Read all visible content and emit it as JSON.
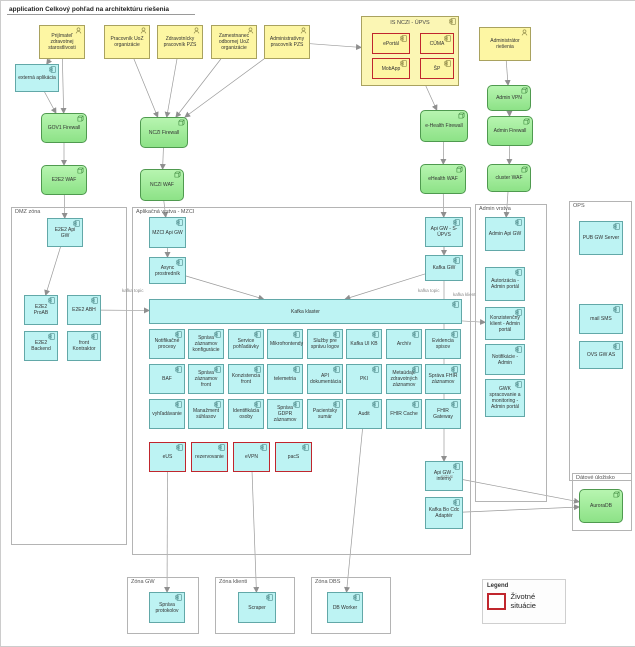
{
  "title": "application Celkový pohľad na architektúru riešenia",
  "legend": {
    "title": "Legend",
    "items": [
      {
        "label": "Životné situácie",
        "color": "#c0262d"
      }
    ]
  },
  "diagram": {
    "containers": [
      {
        "id": "dmz-zona",
        "label": "DMZ zóna",
        "x": 10,
        "y": 206,
        "w": 116,
        "h": 338
      },
      {
        "id": "aplikacna-vrstva-mzci",
        "label": "Aplikačná vrstva - MZCI",
        "x": 131,
        "y": 206,
        "w": 339,
        "h": 348
      },
      {
        "id": "admin-vrstva",
        "label": "Admin vrstva",
        "x": 474,
        "y": 203,
        "w": 72,
        "h": 298
      },
      {
        "id": "ops",
        "label": "OPS",
        "x": 568,
        "y": 200,
        "w": 63,
        "h": 280
      },
      {
        "id": "datove-ulozisko",
        "label": "Dátové úložisko",
        "x": 571,
        "y": 472,
        "w": 60,
        "h": 58
      },
      {
        "id": "zona-gw",
        "label": "Zóna GW",
        "x": 126,
        "y": 576,
        "w": 72,
        "h": 57
      },
      {
        "id": "zona-klienti",
        "label": "Zóna klienti",
        "x": 214,
        "y": 576,
        "w": 80,
        "h": 57
      },
      {
        "id": "zona-dbs",
        "label": "Zóna DBS",
        "x": 310,
        "y": 576,
        "w": 80,
        "h": 57
      }
    ],
    "nodes": [
      {
        "id": "actor-prijimatel",
        "type": "actor",
        "label": "Prijímateľ zdravotnej starostlivosti",
        "x": 38,
        "y": 24,
        "w": 46,
        "h": 34
      },
      {
        "id": "actor-pracovnik-uoz",
        "type": "actor",
        "label": "Pracovník UoZ organizácie",
        "x": 103,
        "y": 24,
        "w": 46,
        "h": 34
      },
      {
        "id": "actor-zdravotnicky-pracovnik",
        "type": "actor",
        "label": "Zdravotnícky pracovník PZS",
        "x": 156,
        "y": 24,
        "w": 46,
        "h": 34
      },
      {
        "id": "actor-zamestnanec-odbornej",
        "type": "actor",
        "label": "Zamestnanec odbornej UoZ organizácie",
        "x": 210,
        "y": 24,
        "w": 46,
        "h": 34
      },
      {
        "id": "actor-administrativny",
        "type": "actor",
        "label": "Administratívny pracovník PZS",
        "x": 263,
        "y": 24,
        "w": 46,
        "h": 34
      },
      {
        "id": "actor-administrator",
        "type": "actor",
        "label": "Administrátor riešenia",
        "x": 478,
        "y": 26,
        "w": 52,
        "h": 34
      },
      {
        "id": "externa-aplikacia",
        "type": "app",
        "label": "externá aplikácia",
        "x": 14,
        "y": 63,
        "w": 44,
        "h": 28
      },
      {
        "id": "is-nczi-upvs",
        "type": "ygroup",
        "label": "IS NCZI - ÚPVS",
        "x": 360,
        "y": 15,
        "w": 98,
        "h": 70
      },
      {
        "id": "ls-eportal",
        "type": "yred",
        "label": "ePortál",
        "x": 371,
        "y": 32,
        "w": 38,
        "h": 21
      },
      {
        "id": "ls-cuma",
        "type": "yred",
        "label": "CÚMA",
        "x": 419,
        "y": 32,
        "w": 34,
        "h": 21
      },
      {
        "id": "ls-mobapp",
        "type": "yred",
        "label": "MobApp",
        "x": 371,
        "y": 57,
        "w": 38,
        "h": 21
      },
      {
        "id": "ls-sp",
        "type": "yred",
        "label": "ŠP",
        "x": 419,
        "y": 57,
        "w": 34,
        "h": 21
      },
      {
        "id": "gov1-firewall",
        "type": "gnode",
        "label": "GOV1 Firewall",
        "x": 40,
        "y": 112,
        "w": 46,
        "h": 30
      },
      {
        "id": "e2e2-waf",
        "type": "gnode",
        "label": "E2E2 WAF",
        "x": 40,
        "y": 164,
        "w": 46,
        "h": 30
      },
      {
        "id": "nczi-firewall",
        "type": "gnode",
        "label": "NCZI Firewall",
        "x": 139,
        "y": 116,
        "w": 48,
        "h": 31
      },
      {
        "id": "nczi-waf",
        "type": "gnode",
        "label": "NCZI WAF",
        "x": 139,
        "y": 168,
        "w": 44,
        "h": 32
      },
      {
        "id": "ehealth-firewall",
        "type": "gnode",
        "label": "e-Health Firewall",
        "x": 419,
        "y": 109,
        "w": 48,
        "h": 32
      },
      {
        "id": "ehealth-waf",
        "type": "gnode",
        "label": "eHealth WAF",
        "x": 419,
        "y": 163,
        "w": 46,
        "h": 30
      },
      {
        "id": "admin-vpn",
        "type": "gnode",
        "label": "Admin VPN",
        "x": 486,
        "y": 84,
        "w": 44,
        "h": 26
      },
      {
        "id": "admin-firewall",
        "type": "gnode",
        "label": "Admin Firewall",
        "x": 486,
        "y": 115,
        "w": 46,
        "h": 30
      },
      {
        "id": "cluster-waf",
        "type": "gnode",
        "label": "cluster WAF",
        "x": 486,
        "y": 163,
        "w": 44,
        "h": 28
      },
      {
        "id": "auroradb",
        "type": "gnode",
        "label": "AuroraDB",
        "x": 578,
        "y": 488,
        "w": 44,
        "h": 34
      },
      {
        "id": "e2e2-api-gw",
        "type": "app",
        "label": "E2E2 Api GW",
        "x": 46,
        "y": 217,
        "w": 36,
        "h": 29
      },
      {
        "id": "e2e2-proab",
        "type": "app",
        "label": "E2E2 ProAB",
        "x": 23,
        "y": 294,
        "w": 34,
        "h": 30
      },
      {
        "id": "e2e2-abh",
        "type": "app",
        "label": "E2E2 ABH",
        "x": 66,
        "y": 294,
        "w": 34,
        "h": 30
      },
      {
        "id": "e2e2-backend",
        "type": "app",
        "label": "E2E2 Backend",
        "x": 23,
        "y": 330,
        "w": 34,
        "h": 30
      },
      {
        "id": "front-kontraktor",
        "type": "app",
        "label": "front Kontraktor",
        "x": 66,
        "y": 330,
        "w": 34,
        "h": 30
      },
      {
        "id": "mzci-api-gw",
        "type": "app",
        "label": "MZCI Api GW",
        "x": 148,
        "y": 216,
        "w": 37,
        "h": 31
      },
      {
        "id": "async-prostrednik",
        "type": "app",
        "label": "Async prostredník",
        "x": 148,
        "y": 256,
        "w": 37,
        "h": 27
      },
      {
        "id": "kafka-klaster",
        "type": "app",
        "label": "Kafka klaster",
        "x": 148,
        "y": 298,
        "w": 313,
        "h": 25
      },
      {
        "id": "notifikacne-procesy",
        "type": "app",
        "label": "Notifikačné procesy",
        "x": 148,
        "y": 328,
        "w": 36,
        "h": 30
      },
      {
        "id": "sprava-zaznamov-konfiguracie",
        "type": "app",
        "label": "Správa záznamov konfigurácie",
        "x": 187,
        "y": 328,
        "w": 36,
        "h": 30
      },
      {
        "id": "service-pohladavky",
        "type": "app",
        "label": "Service pohľadávky",
        "x": 227,
        "y": 328,
        "w": 36,
        "h": 30
      },
      {
        "id": "mikrofrontendy",
        "type": "app",
        "label": "Mikrofrontendy",
        "x": 266,
        "y": 328,
        "w": 36,
        "h": 30
      },
      {
        "id": "sluzby-pre-spravu-logov",
        "type": "app",
        "label": "Služby pre správu logov",
        "x": 306,
        "y": 328,
        "w": 36,
        "h": 30
      },
      {
        "id": "kafka-ui-kb",
        "type": "app",
        "label": "Kafka UI KB",
        "x": 345,
        "y": 328,
        "w": 36,
        "h": 30
      },
      {
        "id": "archiv",
        "type": "app",
        "label": "Archív",
        "x": 385,
        "y": 328,
        "w": 36,
        "h": 30
      },
      {
        "id": "evidencia-spisov",
        "type": "app",
        "label": "Evidencia spisov",
        "x": 424,
        "y": 328,
        "w": 36,
        "h": 30
      },
      {
        "id": "baf",
        "type": "app",
        "label": "BAF",
        "x": 148,
        "y": 363,
        "w": 36,
        "h": 30
      },
      {
        "id": "sprava-zaznamov-front",
        "type": "app",
        "label": "Správa záznamov front",
        "x": 187,
        "y": 363,
        "w": 36,
        "h": 30
      },
      {
        "id": "konzistencia-front",
        "type": "app",
        "label": "Konzistencia front",
        "x": 227,
        "y": 363,
        "w": 36,
        "h": 30
      },
      {
        "id": "telemetria",
        "type": "app",
        "label": "telemetria",
        "x": 266,
        "y": 363,
        "w": 36,
        "h": 30
      },
      {
        "id": "api-dokumentacia",
        "type": "app",
        "label": "API dokumentácia",
        "x": 306,
        "y": 363,
        "w": 36,
        "h": 30
      },
      {
        "id": "pki",
        "type": "app",
        "label": "PKI",
        "x": 345,
        "y": 363,
        "w": 36,
        "h": 30
      },
      {
        "id": "metaudaje-zdravotnych-zaznamov",
        "type": "app",
        "label": "Metaúdaje zdravotných záznamov",
        "x": 385,
        "y": 363,
        "w": 36,
        "h": 30
      },
      {
        "id": "sprava-fhir-zaznamov",
        "type": "app",
        "label": "Správa FHIR záznamov",
        "x": 424,
        "y": 363,
        "w": 36,
        "h": 30
      },
      {
        "id": "vyhladavanie",
        "type": "app",
        "label": "vyhľadávanie",
        "x": 148,
        "y": 398,
        "w": 36,
        "h": 30
      },
      {
        "id": "manazment-suhlasov",
        "type": "app",
        "label": "Manažment súhlasov",
        "x": 187,
        "y": 398,
        "w": 36,
        "h": 30
      },
      {
        "id": "identifikacia-osoby",
        "type": "app",
        "label": "Identifikácia osoby",
        "x": 227,
        "y": 398,
        "w": 36,
        "h": 30
      },
      {
        "id": "sprava-gdpr-zaznamov",
        "type": "app",
        "label": "Správa GDPR záznamov",
        "x": 266,
        "y": 398,
        "w": 36,
        "h": 30
      },
      {
        "id": "pacientsky-sumar",
        "type": "app",
        "label": "Pacientsky sumár",
        "x": 306,
        "y": 398,
        "w": 36,
        "h": 30
      },
      {
        "id": "audit",
        "type": "app",
        "label": "Audit",
        "x": 345,
        "y": 398,
        "w": 36,
        "h": 30
      },
      {
        "id": "fhir-cache",
        "type": "app",
        "label": "FHIR Cache",
        "x": 385,
        "y": 398,
        "w": 36,
        "h": 30
      },
      {
        "id": "fhir-gateway",
        "type": "app",
        "label": "FHIR Gateway",
        "x": 424,
        "y": 398,
        "w": 36,
        "h": 30
      },
      {
        "id": "ls-eus",
        "type": "cred",
        "label": "eUS",
        "x": 148,
        "y": 441,
        "w": 37,
        "h": 30
      },
      {
        "id": "ls-rezervovanie",
        "type": "cred",
        "label": "rezervovanie",
        "x": 190,
        "y": 441,
        "w": 37,
        "h": 30
      },
      {
        "id": "ls-evpn",
        "type": "cred",
        "label": "eVPN",
        "x": 232,
        "y": 441,
        "w": 37,
        "h": 30
      },
      {
        "id": "ls-pacs",
        "type": "cred",
        "label": "pacS",
        "x": 274,
        "y": 441,
        "w": 37,
        "h": 30
      },
      {
        "id": "api-gw-s-upvs",
        "type": "app",
        "label": "Api GW - S-ÚPVS",
        "x": 424,
        "y": 216,
        "w": 38,
        "h": 30
      },
      {
        "id": "kafka-gw",
        "type": "app",
        "label": "Kafka GW",
        "x": 424,
        "y": 254,
        "w": 38,
        "h": 26
      },
      {
        "id": "api-gw-interny",
        "type": "app",
        "label": "Api GW - interný",
        "x": 424,
        "y": 460,
        "w": 38,
        "h": 30
      },
      {
        "id": "kafka-bo-cdc-adapter",
        "type": "app",
        "label": "Kafka Bo Cdc Adaptér",
        "x": 424,
        "y": 496,
        "w": 38,
        "h": 32
      },
      {
        "id": "admin-api-gw",
        "type": "app",
        "label": "Admin Api GW",
        "x": 484,
        "y": 216,
        "w": 40,
        "h": 34
      },
      {
        "id": "autorizacia-admin-portal",
        "type": "app",
        "label": "Autorizácia - Admin portál",
        "x": 484,
        "y": 266,
        "w": 40,
        "h": 34
      },
      {
        "id": "konzistencny-klient-admin-portal",
        "type": "app",
        "label": "Konzistenčný klient - Admin portál",
        "x": 484,
        "y": 306,
        "w": 40,
        "h": 33
      },
      {
        "id": "notifikacie-admin",
        "type": "app",
        "label": "Notifikácie - Admin",
        "x": 484,
        "y": 343,
        "w": 40,
        "h": 31
      },
      {
        "id": "gwk-spracovanie-admin-portal",
        "type": "app",
        "label": "GWK spracovanie a monitoring - Admin portál",
        "x": 484,
        "y": 378,
        "w": 40,
        "h": 38
      },
      {
        "id": "pub-gw-server",
        "type": "app",
        "label": "PUB GW Server",
        "x": 578,
        "y": 220,
        "w": 44,
        "h": 34
      },
      {
        "id": "mail-sms",
        "type": "app",
        "label": "mail SMS",
        "x": 578,
        "y": 303,
        "w": 44,
        "h": 30
      },
      {
        "id": "ovs-gw-as",
        "type": "app",
        "label": "OVS GW AS",
        "x": 578,
        "y": 340,
        "w": 44,
        "h": 28
      },
      {
        "id": "sprava-protokolov",
        "type": "app",
        "label": "Správa protokolov",
        "x": 148,
        "y": 591,
        "w": 36,
        "h": 31
      },
      {
        "id": "scraper",
        "type": "app",
        "label": "Scraper",
        "x": 237,
        "y": 591,
        "w": 38,
        "h": 31
      },
      {
        "id": "db-worker",
        "type": "app",
        "label": "DB Worker",
        "x": 326,
        "y": 591,
        "w": 36,
        "h": 31
      }
    ],
    "edges": [
      {
        "from": "actor-prijimatel",
        "to": "externa-aplikacia"
      },
      {
        "from": "actor-prijimatel",
        "to": "gov1-firewall"
      },
      {
        "from": "externa-aplikacia",
        "to": "gov1-firewall"
      },
      {
        "from": "actor-pracovnik-uoz",
        "to": "nczi-firewall"
      },
      {
        "from": "actor-zdravotnicky-pracovnik",
        "to": "nczi-firewall"
      },
      {
        "from": "actor-zamestnanec-odbornej",
        "to": "nczi-firewall"
      },
      {
        "from": "actor-administrativny",
        "to": "nczi-firewall"
      },
      {
        "from": "actor-administrativny",
        "to": "is-nczi-upvs"
      },
      {
        "from": "is-nczi-upvs",
        "to": "ehealth-firewall"
      },
      {
        "from": "actor-administrator",
        "to": "admin-vpn"
      },
      {
        "from": "admin-vpn",
        "to": "admin-firewall"
      },
      {
        "from": "admin-firewall",
        "to": "cluster-waf"
      },
      {
        "from": "cluster-waf",
        "to": "admin-api-gw"
      },
      {
        "from": "gov1-firewall",
        "to": "e2e2-waf"
      },
      {
        "from": "e2e2-waf",
        "to": "e2e2-api-gw"
      },
      {
        "from": "nczi-firewall",
        "to": "nczi-waf"
      },
      {
        "from": "nczi-waf",
        "to": "mzci-api-gw"
      },
      {
        "from": "ehealth-firewall",
        "to": "ehealth-waf"
      },
      {
        "from": "ehealth-waf",
        "to": "api-gw-s-upvs"
      },
      {
        "from": "mzci-api-gw",
        "to": "async-prostrednik"
      },
      {
        "from": "async-prostrednik",
        "to": "kafka-klaster"
      },
      {
        "from": "api-gw-s-upvs",
        "to": "kafka-gw"
      },
      {
        "from": "kafka-gw",
        "to": "kafka-klaster"
      },
      {
        "from": "e2e2-abh",
        "to": "kafka-klaster"
      },
      {
        "from": "kafka-klaster",
        "to": "konzistencny-klient-admin-portal"
      },
      {
        "from": "ls-eus",
        "to": "sprava-protokolov"
      },
      {
        "from": "ls-evpn",
        "to": "scraper"
      },
      {
        "from": "audit",
        "to": "db-worker"
      },
      {
        "from": "api-gw-s-upvs",
        "to": "api-gw-interny"
      },
      {
        "from": "api-gw-interny",
        "to": "auroradb"
      },
      {
        "from": "kafka-bo-cdc-adapter",
        "to": "auroradb"
      },
      {
        "from": "e2e2-api-gw",
        "to": "e2e2-proab"
      }
    ],
    "edge_labels": [
      {
        "text": "kafka topic",
        "x": 121,
        "y": 287
      },
      {
        "text": "kafka topic",
        "x": 417,
        "y": 287
      },
      {
        "text": "kafka klient",
        "x": 452,
        "y": 291
      },
      {
        "text": "mTLS",
        "x": 440,
        "y": 473
      }
    ]
  }
}
